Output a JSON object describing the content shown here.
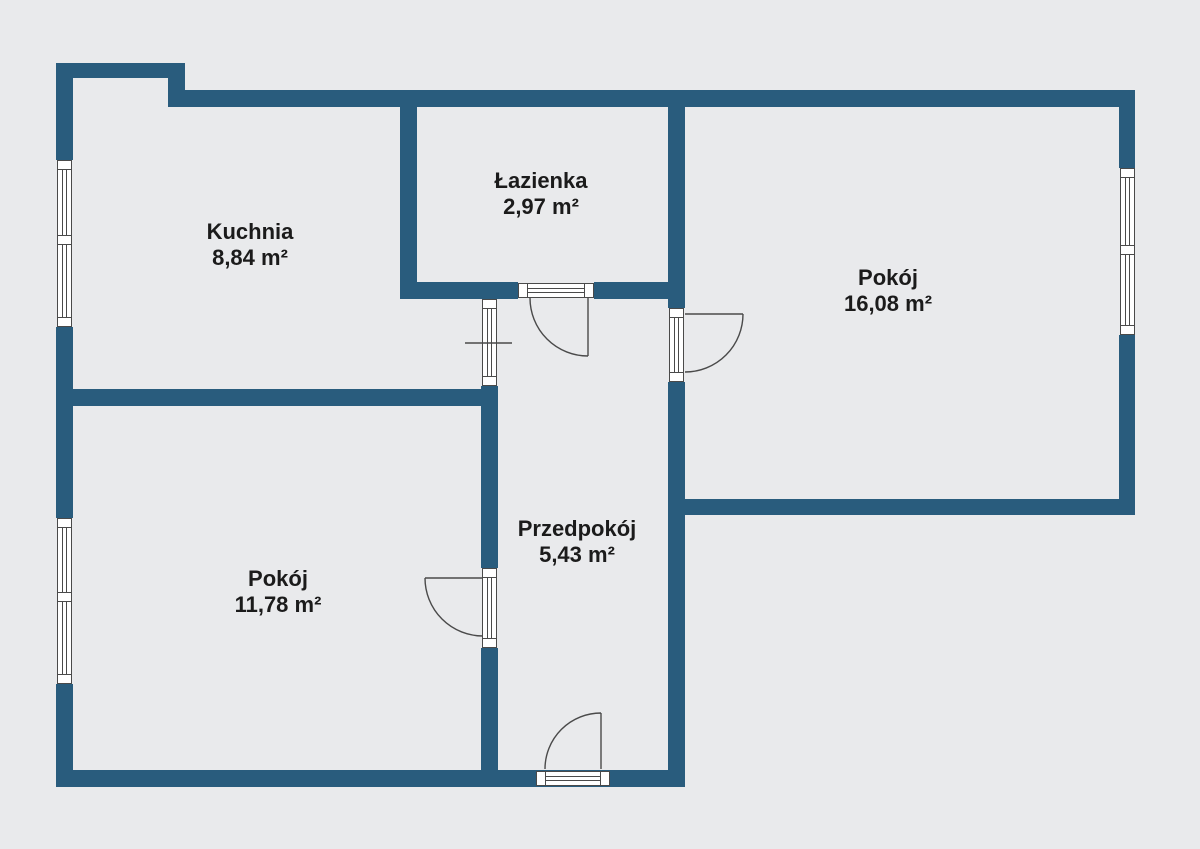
{
  "plan": {
    "rooms": [
      {
        "id": "kuchnia",
        "name": "Kuchnia",
        "area": "8,84 m²"
      },
      {
        "id": "lazienka",
        "name": "Łazienka",
        "area": "2,97 m²"
      },
      {
        "id": "pokoj-duzy",
        "name": "Pokój",
        "area": "16,08 m²"
      },
      {
        "id": "przedpokoj",
        "name": "Przedpokój",
        "area": "5,43 m²"
      },
      {
        "id": "pokoj-maly",
        "name": "Pokój",
        "area": "11,78 m²"
      }
    ],
    "colors": {
      "wall": "#295c7d",
      "background": "#e9eaec",
      "window_line": "#4a4a4a",
      "door_arc": "#4a4a4a",
      "text": "#1b1b1b"
    }
  }
}
